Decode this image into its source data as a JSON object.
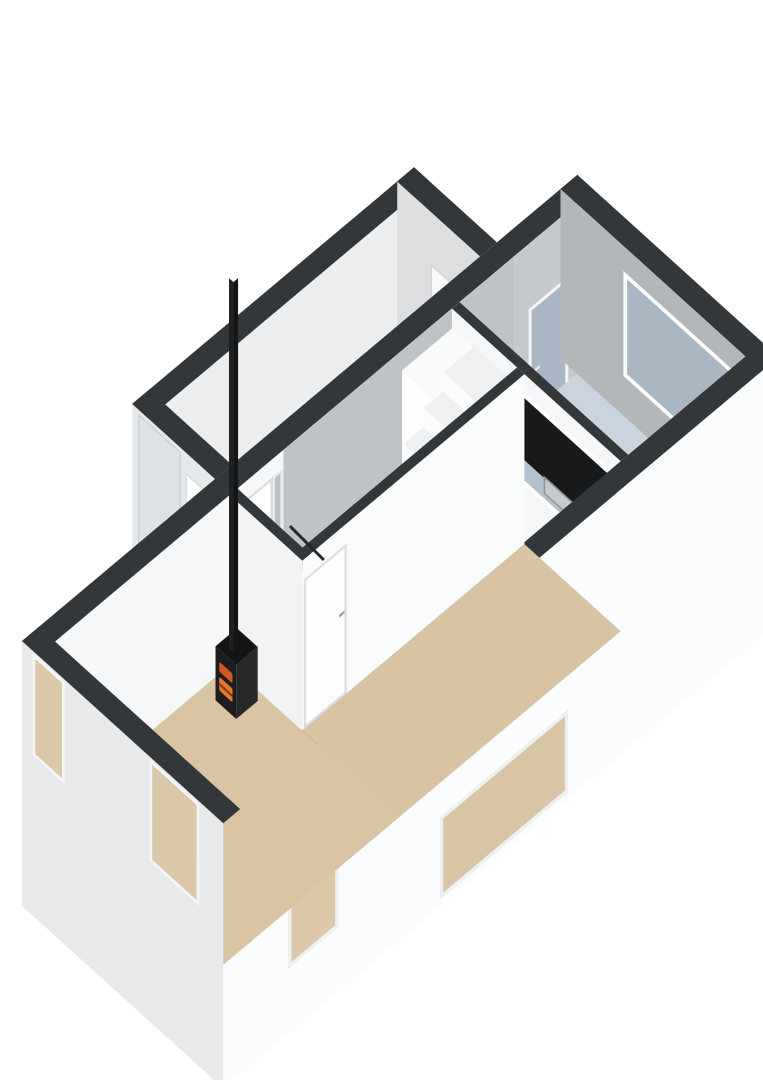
{
  "palette": {
    "background": "#ffffff",
    "wall_top": "#34373a",
    "outer_bright": "#fbfcfd",
    "outer_front": "#e7e9eb",
    "inner_gray": "#b3b7ba",
    "living_floor": "#d9c5a3",
    "kitchen_floor": "#c9d4df",
    "garage_floor": "#c9cccd",
    "hall_floor": "#e9eaeb",
    "counter_top": "#b9c6d3",
    "stove_black": "#1c1d1f",
    "fire_glow": "#d2561f",
    "glass_frosted": "#a9b7c4",
    "glass_interior": "#dbc8a8"
  },
  "scene": {
    "projection": {
      "u": [
        0.74,
        0.67
      ],
      "v": [
        0.766,
        -0.643
      ],
      "o": [
        22,
        811
      ]
    },
    "faces": [
      {
        "n": "garage-nw-wall-top",
        "t": "flat",
        "x": -112,
        "y": 252,
        "z": 170,
        "w": 22,
        "h": 368,
        "bg": "top"
      },
      {
        "n": "garage-nw-wall-inner",
        "t": "wy",
        "x": -90,
        "y": 252,
        "z": 170,
        "w": 368,
        "h": 170,
        "bg": "#ecedee"
      },
      {
        "n": "garage-back-wall-inner",
        "t": "wx",
        "x": -112,
        "y": 598,
        "z": 170,
        "w": 112,
        "h": 170,
        "bg": "#dcdee0",
        "kids": [
          {
            "n": "garage-back-window",
            "l": 44,
            "t": 51,
            "w": 64,
            "h": 53,
            "bg": "#f8f9fa",
            "bw": 3,
            "bc": "#d5d8da"
          }
        ]
      },
      {
        "n": "garage-back-wall-top",
        "t": "flat",
        "x": -112,
        "y": 598,
        "z": 170,
        "w": 112,
        "h": 22,
        "bg": "top"
      },
      {
        "n": "garage-floor",
        "t": "flat",
        "x": -90,
        "y": 274,
        "z": 0,
        "w": 90,
        "h": 324,
        "bg": "garage"
      },
      {
        "n": "garage-front-wall-outer",
        "t": "wx",
        "x": -112,
        "y": 252,
        "z": 170,
        "w": 112,
        "h": 265,
        "bg": "#e6e8ea",
        "kids": [
          {
            "n": "garage-roller-door",
            "l": 8,
            "t": 4,
            "w": 58,
            "h": 153,
            "bg": "#dfe2e4",
            "cls": "slats",
            "bw": 2,
            "bc": "#cfd2d4"
          },
          {
            "n": "garage-side-door",
            "l": 72,
            "t": 20,
            "w": 30,
            "h": 150,
            "bg": "#fdfdfd",
            "bw": 2,
            "bc": "#d8dadc"
          },
          {
            "n": "garage-side-door-handle",
            "l": 76,
            "t": 95,
            "w": 5,
            "h": 3,
            "bg": "#97999c"
          }
        ]
      },
      {
        "n": "garage-front-wall-top",
        "t": "flat",
        "x": -112,
        "y": 252,
        "z": 170,
        "w": 112,
        "h": 22,
        "bg": "top"
      },
      {
        "n": "nw-wall-top",
        "t": "flat",
        "x": 0,
        "y": 0,
        "z": 170,
        "w": 22,
        "h": 725,
        "bg": "top"
      },
      {
        "n": "nw-wall-inner",
        "t": "wy",
        "x": 22,
        "y": 0,
        "z": 170,
        "w": 725,
        "h": 250,
        "bg": "#f6f7f8",
        "kids": [
          {
            "n": "nw-wall-garage-stretch",
            "l": 320,
            "t": 0,
            "w": 302,
            "h": 250,
            "bg": "#c0c3c6"
          },
          {
            "n": "nw-wall-kitchen-stretch",
            "l": 622,
            "t": 0,
            "w": 103,
            "h": 250,
            "bg": "#c6c9cc"
          },
          {
            "n": "front-door",
            "l": 252,
            "t": 18,
            "w": 54,
            "h": 152,
            "bg": "#fcfdfd",
            "bw": 3,
            "bc": "#d9dbdd"
          },
          {
            "n": "front-door-handle",
            "l": 258,
            "t": 88,
            "w": 6,
            "h": 3,
            "bg": "#95989b"
          },
          {
            "n": "front-door-sidelight",
            "l": 306,
            "t": 18,
            "w": 13,
            "h": 152,
            "bg": "#b7c1cc",
            "bw": 3,
            "bc": "#e8eaeb"
          },
          {
            "n": "kitchen-back-door",
            "l": 640,
            "t": 65,
            "w": 52,
            "h": 150,
            "bg": "#a9b7c4",
            "cls": "speckle",
            "bw": 4,
            "bc": "#f2f4f5"
          },
          {
            "n": "kitchen-back-door-handle",
            "l": 648,
            "t": 130,
            "w": 7,
            "h": 3,
            "bg": "#e8e9ea"
          }
        ]
      },
      {
        "n": "back-wall-top",
        "t": "flat",
        "x": 0,
        "y": 703,
        "z": 170,
        "w": 272,
        "h": 22,
        "bg": "top"
      },
      {
        "n": "back-wall-inner",
        "t": "wx",
        "x": 0,
        "y": 703,
        "z": 170,
        "w": 272,
        "h": 170,
        "bg": "inner",
        "kids": [
          {
            "n": "kitchen-window",
            "l": 85,
            "t": 25,
            "w": 160,
            "h": 105,
            "bg": "#aab7c3",
            "cls": "speckle",
            "bw": 5,
            "bc": "#fbfcfd"
          }
        ]
      },
      {
        "n": "kitchen-floor",
        "t": "flat",
        "x": 22,
        "y": 550,
        "z": 0,
        "w": 228,
        "h": 153,
        "bg": "kitchen"
      },
      {
        "n": "kitchen-counter-top",
        "t": "flat",
        "x": 95,
        "y": 550,
        "z": 55,
        "w": 153,
        "h": 58,
        "bg": "counter",
        "kids": [
          {
            "n": "sink",
            "l": 30,
            "t": 9,
            "w": 46,
            "h": 38,
            "bg": "#cdd0d2",
            "bw": 2,
            "bc": "#9fa3a6"
          },
          {
            "n": "sink-bowl",
            "l": 36,
            "t": 15,
            "w": 34,
            "h": 26,
            "bg": "#dfe2e3",
            "r": 3
          },
          {
            "n": "sink-faucet",
            "l": 48,
            "t": 10,
            "w": 10,
            "h": 4,
            "bg": "#8e9295"
          }
        ]
      },
      {
        "n": "kitchen-counter-side",
        "t": "wy",
        "x": 248,
        "y": 550,
        "z": 55,
        "w": 58,
        "h": 55,
        "bg": "#f4f5f6"
      },
      {
        "n": "partition-wall-top",
        "t": "flat",
        "x": 22,
        "y": 540,
        "z": 170,
        "w": 228,
        "h": 10,
        "bg": "top"
      },
      {
        "n": "partition-wall-front",
        "t": "wx",
        "x": 22,
        "y": 540,
        "z": 170,
        "w": 228,
        "h": 170,
        "bg": "#f5f6f7",
        "kids": [
          {
            "n": "pass-through-frame",
            "l": 74,
            "t": 18,
            "w": 154,
            "h": 94,
            "bg": "#fdfefe"
          },
          {
            "n": "pass-through-opening",
            "l": 80,
            "t": 24,
            "w": 142,
            "h": 82,
            "bg": "#17191b"
          },
          {
            "n": "pass-through-counter-edge",
            "l": 80,
            "t": 86,
            "w": 142,
            "h": 20,
            "bg": "#b4c1ce"
          },
          {
            "n": "pass-through-sink",
            "l": 124,
            "t": 84,
            "w": 40,
            "h": 18,
            "bg": "#c8cbcd",
            "bw": 2,
            "bc": "#8f9396"
          }
        ]
      },
      {
        "n": "kitchen-cabinet-front",
        "t": "wx",
        "x": 22,
        "y": 475,
        "z": 150,
        "w": 66,
        "h": 150,
        "bg": "#fdfdfe"
      },
      {
        "n": "kitchen-cabinet-side",
        "t": "wy",
        "x": 88,
        "y": 475,
        "z": 150,
        "w": 65,
        "h": 150,
        "bg": "#eef0f1"
      },
      {
        "n": "kitchen-cabinet-top",
        "t": "flat",
        "x": 22,
        "y": 475,
        "z": 150,
        "w": 66,
        "h": 65,
        "bg": "#f9fafa"
      },
      {
        "n": "se-wall-top",
        "t": "flat",
        "x": 250,
        "y": 0,
        "z": 170,
        "w": 22,
        "h": 725,
        "bg": "top"
      },
      {
        "n": "se-wall-outer",
        "t": "wy",
        "x": 272,
        "y": 0,
        "z": 170,
        "w": 725,
        "h": 265,
        "bg": "outerB",
        "kids": [
          {
            "n": "se-window-1",
            "l": 85,
            "t": 122,
            "w": 65,
            "h": 78,
            "bg": "#dcc9a9",
            "bw": 4,
            "bc": "#eff0f1"
          },
          {
            "n": "se-window-2",
            "l": 283,
            "t": 176,
            "w": 167,
            "h": 82,
            "bg": "#d8c5a6",
            "bw": 4,
            "bc": "#eff0f1"
          }
        ]
      },
      {
        "n": "living-floor-front",
        "t": "flat",
        "x": 22,
        "y": 22,
        "z": 0,
        "w": 228,
        "h": 228,
        "bg": "living"
      },
      {
        "n": "living-floor-back",
        "t": "flat",
        "x": 120,
        "y": 250,
        "z": 0,
        "w": 130,
        "h": 290,
        "bg": "#d8c4a2"
      },
      {
        "n": "hall-floor",
        "t": "flat",
        "x": 22,
        "y": 260,
        "z": 0,
        "w": 88,
        "h": 280,
        "bg": "hall"
      },
      {
        "n": "stair-riser",
        "t": "wx",
        "x": 52,
        "y": 318,
        "z": 19,
        "w": 58,
        "h": 19,
        "bg": "#fafbfc"
      },
      {
        "n": "stair-tread",
        "t": "flat",
        "x": 52,
        "y": 318,
        "z": 19,
        "w": 58,
        "h": 26,
        "bg": "#eef0f1"
      },
      {
        "n": "stair-riser",
        "t": "wx",
        "x": 52,
        "y": 344,
        "z": 38,
        "w": 58,
        "h": 19,
        "bg": "#fafbfc"
      },
      {
        "n": "stair-tread",
        "t": "flat",
        "x": 52,
        "y": 344,
        "z": 38,
        "w": 58,
        "h": 26,
        "bg": "#eef0f1"
      },
      {
        "n": "stair-riser",
        "t": "wx",
        "x": 52,
        "y": 370,
        "z": 57,
        "w": 58,
        "h": 19,
        "bg": "#fafbfc"
      },
      {
        "n": "stair-tread",
        "t": "flat",
        "x": 52,
        "y": 370,
        "z": 57,
        "w": 58,
        "h": 26,
        "bg": "#eef0f1"
      },
      {
        "n": "stair-riser",
        "t": "wx",
        "x": 52,
        "y": 396,
        "z": 76,
        "w": 58,
        "h": 19,
        "bg": "#fafbfc"
      },
      {
        "n": "stair-tread",
        "t": "flat",
        "x": 52,
        "y": 396,
        "z": 76,
        "w": 58,
        "h": 26,
        "bg": "#eef0f1"
      },
      {
        "n": "stair-riser",
        "t": "wx",
        "x": 52,
        "y": 422,
        "z": 95,
        "w": 58,
        "h": 19,
        "bg": "#fafbfc"
      },
      {
        "n": "stair-tread",
        "t": "flat",
        "x": 52,
        "y": 422,
        "z": 95,
        "w": 58,
        "h": 26,
        "bg": "#eef0f1"
      },
      {
        "n": "stair-riser",
        "t": "wx",
        "x": 52,
        "y": 448,
        "z": 114,
        "w": 58,
        "h": 19,
        "bg": "#fafbfc"
      },
      {
        "n": "stair-tread",
        "t": "flat",
        "x": 52,
        "y": 448,
        "z": 114,
        "w": 58,
        "h": 26,
        "bg": "#eef0f1"
      },
      {
        "n": "stair-riser",
        "t": "wx",
        "x": 52,
        "y": 474,
        "z": 133,
        "w": 58,
        "h": 19,
        "bg": "#fafbfc"
      },
      {
        "n": "stair-tread",
        "t": "flat",
        "x": 52,
        "y": 474,
        "z": 133,
        "w": 58,
        "h": 26,
        "bg": "#eef0f1"
      },
      {
        "n": "stair-riser",
        "t": "wx",
        "x": 52,
        "y": 500,
        "z": 152,
        "w": 58,
        "h": 19,
        "bg": "#fafbfc"
      },
      {
        "n": "stair-tread",
        "t": "flat",
        "x": 52,
        "y": 500,
        "z": 152,
        "w": 58,
        "h": 26,
        "bg": "#eef0f1"
      },
      {
        "n": "stair-landing",
        "t": "flat",
        "x": 52,
        "y": 526,
        "z": 152,
        "w": 58,
        "h": 14,
        "bg": "#eef0f1"
      },
      {
        "n": "meter-cupboard-shadow",
        "t": "flat",
        "x": 30,
        "y": 264,
        "z": 1,
        "w": 24,
        "h": 44,
        "bg": "#3c3e40"
      },
      {
        "n": "meter-cupboard-item-front",
        "t": "wx",
        "x": 30,
        "y": 282,
        "z": 40,
        "w": 22,
        "h": 40,
        "bg": "#7c5a40"
      },
      {
        "n": "meter-cupboard-item-top",
        "t": "flat",
        "x": 30,
        "y": 282,
        "z": 40,
        "w": 22,
        "h": 20,
        "bg": "#8a6a4f"
      },
      {
        "n": "meter-cupboard-front",
        "t": "wx",
        "x": 22,
        "y": 256,
        "z": 85,
        "w": 40,
        "h": 85,
        "bg": "#f3f4f5"
      },
      {
        "n": "meter-cupboard-side",
        "t": "wy",
        "x": 62,
        "y": 256,
        "z": 85,
        "w": 60,
        "h": 85,
        "bg": "#eceeef"
      },
      {
        "n": "meter-cupboard-front-top",
        "t": "flat",
        "x": 22,
        "y": 256,
        "z": 85,
        "w": 40,
        "h": 8,
        "bg": "top"
      },
      {
        "n": "meter-cupboard-side-top",
        "t": "flat",
        "x": 54,
        "y": 256,
        "z": 85,
        "w": 8,
        "h": 60,
        "bg": "top"
      },
      {
        "n": "hall-se-wall",
        "t": "wy",
        "x": 120,
        "y": 250,
        "z": 170,
        "w": 290,
        "h": 170,
        "bg": "#fafbfb",
        "kids": [
          {
            "n": "hall-door",
            "l": 2,
            "t": 20,
            "w": 56,
            "h": 150,
            "bg": "#fdfdfd",
            "bw": 3,
            "bc": "#dcdee0"
          },
          {
            "n": "hall-door-handle",
            "l": 48,
            "t": 85,
            "w": 7,
            "h": 3,
            "bg": "#9aa0a3"
          }
        ]
      },
      {
        "n": "hall-se-wall-top",
        "t": "flat",
        "x": 110,
        "y": 250,
        "z": 170,
        "w": 10,
        "h": 290,
        "bg": "top"
      },
      {
        "n": "hall-front-wall",
        "t": "wx",
        "x": 22,
        "y": 250,
        "z": 170,
        "w": 98,
        "h": 170,
        "bg": "#f2f3f4"
      },
      {
        "n": "hall-front-wall-top",
        "t": "flat",
        "x": 22,
        "y": 250,
        "z": 170,
        "w": 98,
        "h": 10,
        "bg": "top"
      },
      {
        "n": "wood-stove-front",
        "t": "wx",
        "x": 40,
        "y": 214,
        "z": 54,
        "w": 28,
        "h": 54,
        "bg": "stove",
        "kids": [
          {
            "n": "stove-fire-window",
            "l": 5,
            "t": 12,
            "w": 18,
            "h": 10,
            "bg": "#d2561f",
            "r": 2
          },
          {
            "n": "stove-fire-door",
            "l": 5,
            "t": 27,
            "w": 18,
            "h": 14,
            "bg": "#e07a2b",
            "r": 2
          },
          {
            "n": "stove-fire-door-grate",
            "l": 5,
            "t": 33,
            "w": 18,
            "h": 3,
            "bg": "#8c3a12"
          }
        ]
      },
      {
        "n": "wood-stove-side",
        "t": "wy",
        "x": 68,
        "y": 214,
        "z": 54,
        "w": 28,
        "h": 54,
        "bg": "#26282a"
      },
      {
        "n": "wood-stove-top",
        "t": "flat",
        "x": 40,
        "y": 214,
        "z": 54,
        "w": 28,
        "h": 28,
        "bg": "#131415"
      },
      {
        "n": "stove-chimney-front",
        "t": "wx",
        "x": 51,
        "y": 221,
        "z": 425,
        "w": 6,
        "h": 371,
        "bg": "#1e2022"
      },
      {
        "n": "stove-chimney-side",
        "t": "wy",
        "x": 57,
        "y": 221,
        "z": 425,
        "w": 6,
        "h": 371,
        "bg": "#141517"
      },
      {
        "n": "front-wall-outer",
        "t": "wx",
        "x": 0,
        "y": 0,
        "z": 170,
        "w": 272,
        "h": 265,
        "bg": "outerF",
        "kids": [
          {
            "n": "front-window-1",
            "l": 14,
            "t": 2,
            "w": 44,
            "h": 103,
            "bg": "#dbc8a8",
            "bw": 4,
            "bc": "#f4f5f6"
          },
          {
            "n": "front-window-2",
            "l": 172,
            "t": 2,
            "w": 68,
            "h": 103,
            "bg": "#dbc8a8",
            "bw": 4,
            "bc": "#f4f5f6"
          }
        ]
      },
      {
        "n": "front-wall-top",
        "t": "flat",
        "x": 0,
        "y": 0,
        "z": 170,
        "w": 272,
        "h": 22,
        "bg": "top"
      },
      {
        "n": "stair-handrail",
        "t": "scr",
        "x": 291,
        "y": 525,
        "w": 48,
        "h": 3,
        "rot": 45,
        "bg": "#26282b"
      }
    ]
  }
}
